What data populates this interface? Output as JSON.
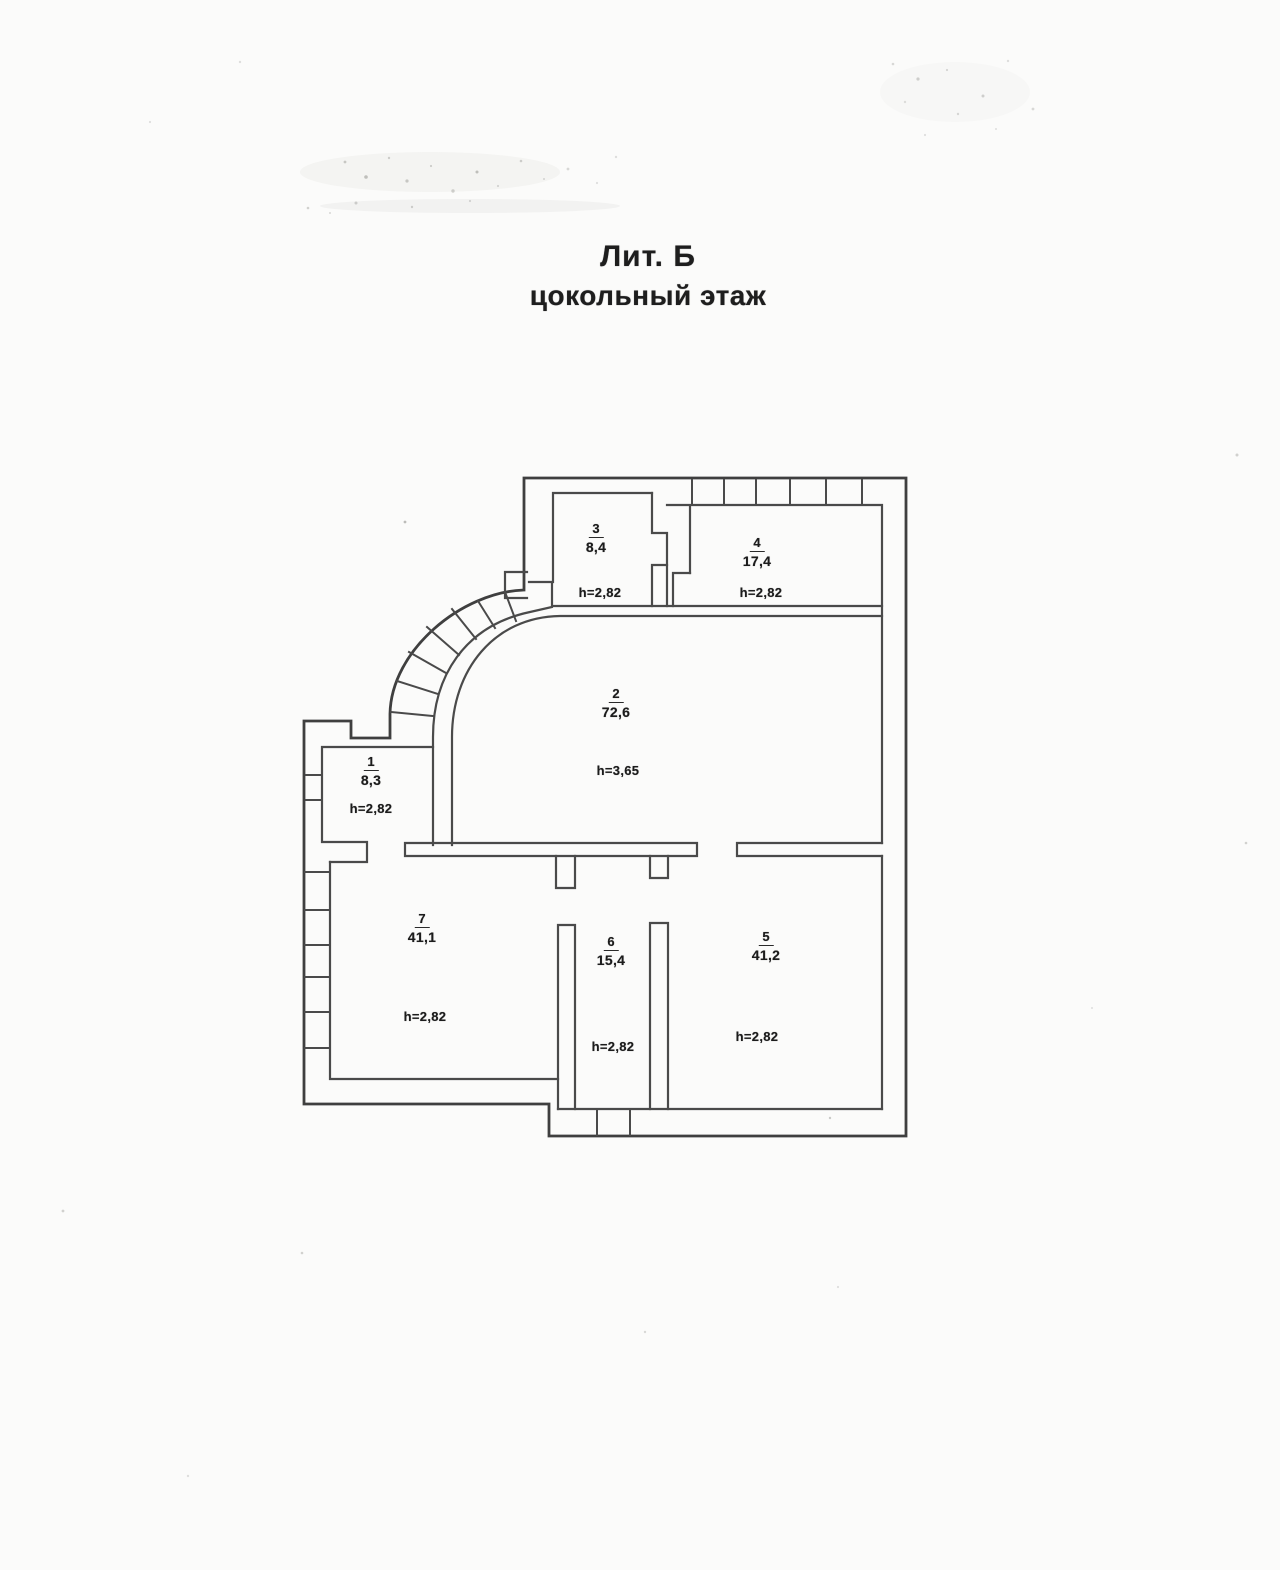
{
  "page": {
    "title_line1": "Лит. Б",
    "title_line2": "цокольный этаж"
  },
  "plan": {
    "rooms": [
      {
        "number": "1",
        "area": "8,3",
        "height_label": "h=2,82"
      },
      {
        "number": "2",
        "area": "72,6",
        "height_label": "h=3,65"
      },
      {
        "number": "3",
        "area": "8,4",
        "height_label": "h=2,82"
      },
      {
        "number": "4",
        "area": "17,4",
        "height_label": "h=2,82"
      },
      {
        "number": "5",
        "area": "41,2",
        "height_label": "h=2,82"
      },
      {
        "number": "6",
        "area": "15,4",
        "height_label": "h=2,82"
      },
      {
        "number": "7",
        "area": "41,1",
        "height_label": "h=2,82"
      }
    ]
  }
}
